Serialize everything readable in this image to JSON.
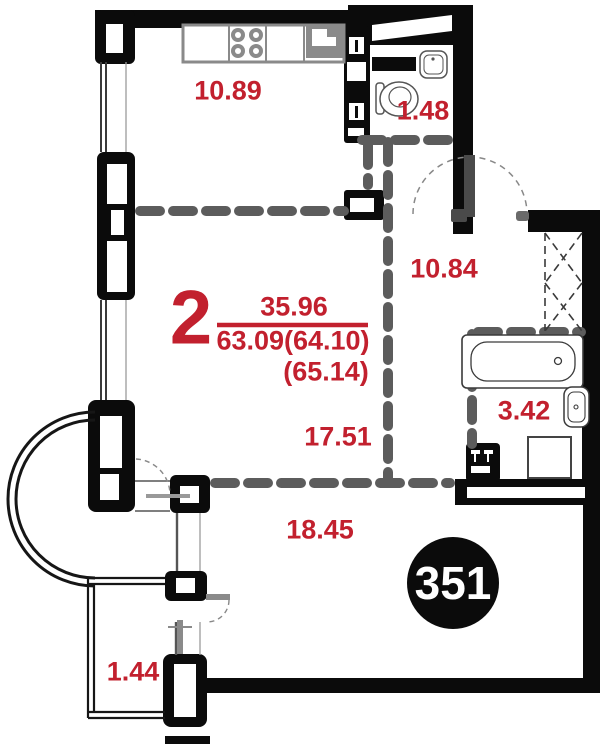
{
  "apartment": {
    "rooms_count": "2",
    "living_area": "35.96",
    "total_area": "63.09(64.10)",
    "total_area_extended": "(65.14)",
    "unit_number": "351"
  },
  "room_labels": {
    "kitchen": "10.89",
    "wc": "1.48",
    "hallway": "10.84",
    "bathroom": "3.42",
    "bedroom": "17.51",
    "living_room": "18.45",
    "balcony": "1.44"
  },
  "colors": {
    "accent_red": "#c2202e",
    "wall_black": "#0b0b0b",
    "partition_gray": "#5c5c5c",
    "fixture_gray": "#8a8a8a",
    "badge_bg": "#0b0b0b",
    "badge_text": "#ffffff"
  }
}
